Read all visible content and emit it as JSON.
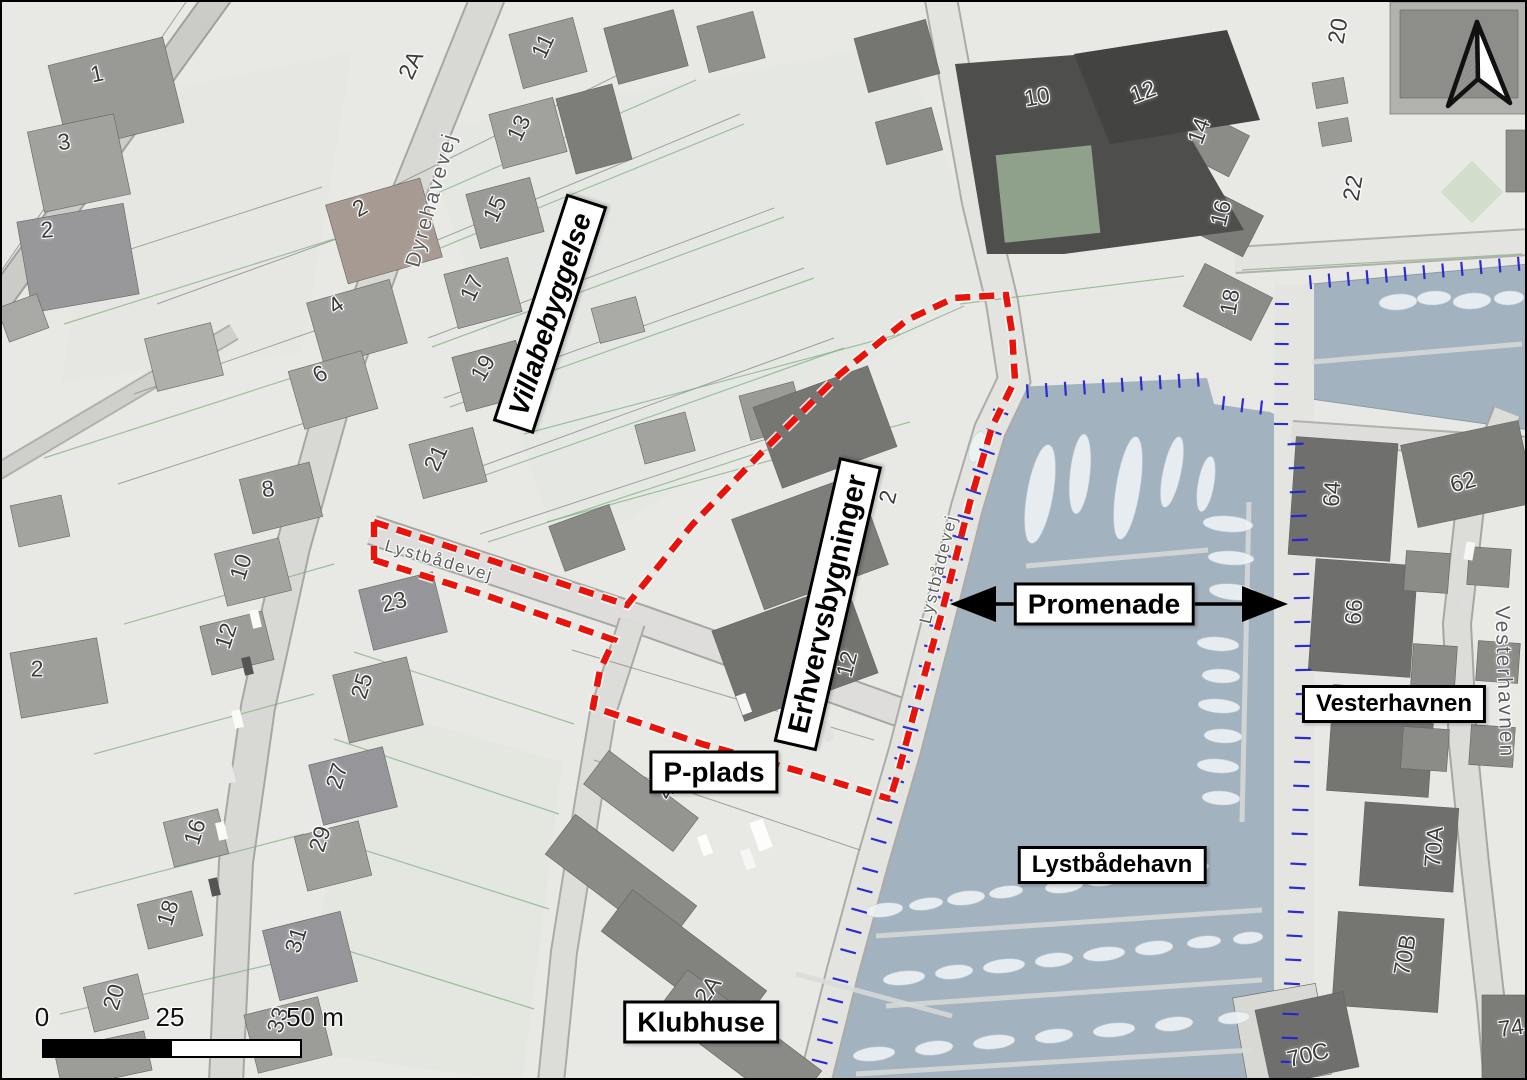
{
  "map": {
    "region_labels": [
      {
        "id": "villabebyggelse",
        "text": "Villabebyggelse",
        "x": 548,
        "y": 312,
        "rot": -72,
        "style": "italic",
        "size": 28
      },
      {
        "id": "erhvervsbygninger",
        "text": "Erhvervsbygninger",
        "x": 826,
        "y": 602,
        "rot": -77,
        "style": "normal",
        "size": 29
      },
      {
        "id": "promenade",
        "text": "Promenade",
        "x": 1102,
        "y": 602,
        "rot": 0,
        "style": "normal",
        "size": 28
      },
      {
        "id": "p-plads",
        "text": "P-plads",
        "x": 712,
        "y": 770,
        "rot": 0,
        "style": "normal",
        "size": 28
      },
      {
        "id": "lystbaadehavn",
        "text": "Lystbådehavn",
        "x": 1110,
        "y": 863,
        "rot": 0,
        "style": "normal",
        "size": 24
      },
      {
        "id": "klubhuse",
        "text": "Klubhuse",
        "x": 699,
        "y": 1020,
        "rot": 0,
        "style": "normal",
        "size": 28
      },
      {
        "id": "vesterhavnen-box",
        "text": "Vesterhavnen",
        "x": 1392,
        "y": 702,
        "rot": 0,
        "style": "normal",
        "size": 24
      }
    ],
    "street_labels": [
      {
        "text": "Dyrehavevej",
        "x": 430,
        "y": 198,
        "rot": -74,
        "size": 21
      },
      {
        "text": "Lystbådevej",
        "x": 437,
        "y": 559,
        "rot": 16,
        "size": 17
      },
      {
        "text": "Lystbådevej",
        "x": 937,
        "y": 567,
        "rot": -76,
        "size": 17
      },
      {
        "text": "Vesterhavnen",
        "x": 1502,
        "y": 680,
        "rot": 88,
        "size": 21
      }
    ],
    "house_numbers": [
      {
        "t": "1",
        "x": 95,
        "y": 72,
        "r": -12
      },
      {
        "t": "3",
        "x": 62,
        "y": 140,
        "r": -8
      },
      {
        "t": "2",
        "x": 45,
        "y": 228,
        "r": -5
      },
      {
        "t": "2",
        "x": 358,
        "y": 206,
        "r": -30
      },
      {
        "t": "4",
        "x": 334,
        "y": 303,
        "r": -35
      },
      {
        "t": "6",
        "x": 318,
        "y": 372,
        "r": -30
      },
      {
        "t": "8",
        "x": 266,
        "y": 487,
        "r": -8
      },
      {
        "t": "10",
        "x": 239,
        "y": 565,
        "r": -72
      },
      {
        "t": "12",
        "x": 224,
        "y": 634,
        "r": -72
      },
      {
        "t": "2",
        "x": 35,
        "y": 667,
        "r": 0
      },
      {
        "t": "23",
        "x": 392,
        "y": 600,
        "r": -14
      },
      {
        "t": "25",
        "x": 360,
        "y": 684,
        "r": -73
      },
      {
        "t": "27",
        "x": 335,
        "y": 774,
        "r": -73
      },
      {
        "t": "29",
        "x": 318,
        "y": 837,
        "r": -73
      },
      {
        "t": "31",
        "x": 294,
        "y": 938,
        "r": -73
      },
      {
        "t": "33",
        "x": 276,
        "y": 1018,
        "r": -73
      },
      {
        "t": "16",
        "x": 193,
        "y": 830,
        "r": -73
      },
      {
        "t": "18",
        "x": 166,
        "y": 911,
        "r": -73
      },
      {
        "t": "20",
        "x": 112,
        "y": 995,
        "r": -73
      },
      {
        "t": "2A",
        "x": 409,
        "y": 63,
        "r": -65
      },
      {
        "t": "11",
        "x": 541,
        "y": 44,
        "r": -65
      },
      {
        "t": "13",
        "x": 517,
        "y": 126,
        "r": -65
      },
      {
        "t": "15",
        "x": 493,
        "y": 207,
        "r": -65
      },
      {
        "t": "17",
        "x": 470,
        "y": 286,
        "r": -65
      },
      {
        "t": "19",
        "x": 481,
        "y": 366,
        "r": -60
      },
      {
        "t": "21",
        "x": 434,
        "y": 456,
        "r": -65
      },
      {
        "t": "2",
        "x": 886,
        "y": 495,
        "r": -76
      },
      {
        "t": "12",
        "x": 845,
        "y": 662,
        "r": -76
      },
      {
        "t": "4",
        "x": 664,
        "y": 790,
        "r": -60
      },
      {
        "t": "2A",
        "x": 706,
        "y": 988,
        "r": -55
      },
      {
        "t": "10",
        "x": 1035,
        "y": 95,
        "r": -10
      },
      {
        "t": "12",
        "x": 1141,
        "y": 90,
        "r": -20
      },
      {
        "t": "14",
        "x": 1197,
        "y": 129,
        "r": -70
      },
      {
        "t": "16",
        "x": 1219,
        "y": 211,
        "r": -76
      },
      {
        "t": "18",
        "x": 1228,
        "y": 300,
        "r": -80
      },
      {
        "t": "20",
        "x": 1336,
        "y": 29,
        "r": -80
      },
      {
        "t": "22",
        "x": 1351,
        "y": 186,
        "r": -80
      },
      {
        "t": "62",
        "x": 1461,
        "y": 480,
        "r": -15
      },
      {
        "t": "64",
        "x": 1330,
        "y": 492,
        "r": -86
      },
      {
        "t": "66",
        "x": 1352,
        "y": 610,
        "r": -86
      },
      {
        "t": "70A",
        "x": 1432,
        "y": 845,
        "r": -86
      },
      {
        "t": "70B",
        "x": 1403,
        "y": 953,
        "r": -80
      },
      {
        "t": "70C",
        "x": 1306,
        "y": 1053,
        "r": -14
      },
      {
        "t": "74",
        "x": 1509,
        "y": 1026,
        "r": -8
      }
    ],
    "scale_bar": {
      "start": "0",
      "mid": "25",
      "end": "50 m"
    },
    "colors": {
      "boundary": "#e8130a",
      "quay_hatch": "#2424cf",
      "water": "#a3b2bf"
    }
  }
}
